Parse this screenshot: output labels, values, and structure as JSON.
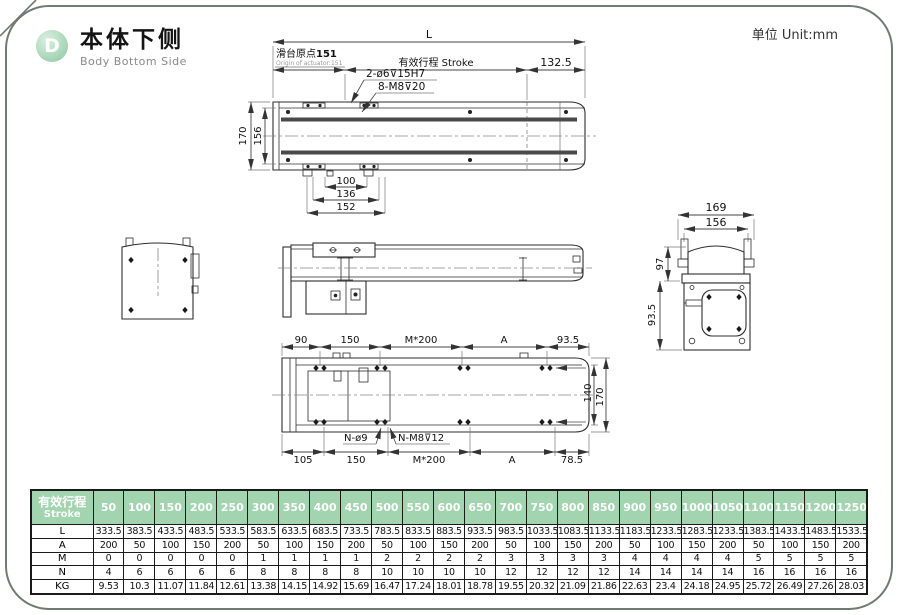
{
  "header": {
    "badge": "D",
    "title": "本体下侧",
    "subtitle": "Body Bottom Side",
    "unit_label": "单位 Unit:mm"
  },
  "colors": {
    "accent_green": "#a2d4af",
    "badge_green": "#8cc7a0",
    "line": "#444444",
    "border": "#6f7a72"
  },
  "top_view": {
    "dim_L": "L",
    "origin_label": "滑台原点",
    "origin_value": "151",
    "origin_sub": "Origin of actuator:151",
    "stroke_label": "有效行程 Stroke",
    "dim_right": "132.5",
    "dim_height_outer": "170",
    "dim_height_inner": "156",
    "hole_note_1": "2-ø6⊽15H7",
    "hole_note_2": "8-M8⊽20",
    "dim_w1": "100",
    "dim_w2": "136",
    "dim_w3": "152"
  },
  "end_view": {
    "dim_w_outer": "169",
    "dim_w_inner": "156",
    "dim_h_upper": "97",
    "dim_h_lower": "93.5"
  },
  "bottom_view": {
    "dims_top": [
      "90",
      "150",
      "M*200",
      "A",
      "93.5"
    ],
    "dims_bottom": [
      "105",
      "150",
      "M*200",
      "A",
      "78.5"
    ],
    "note_1": "N-ø9",
    "note_2": "N-M8⊽12",
    "dim_h_inner": "140",
    "dim_h_outer": "170"
  },
  "table": {
    "header_label_cn": "有效行程",
    "header_label_en": "Stroke",
    "stroke_values": [
      "50",
      "100",
      "150",
      "200",
      "250",
      "300",
      "350",
      "400",
      "450",
      "500",
      "550",
      "600",
      "650",
      "700",
      "750",
      "800",
      "850",
      "900",
      "950",
      "1000",
      "1050",
      "1100",
      "1150",
      "1200",
      "1250"
    ],
    "rows": [
      {
        "label": "L",
        "values": [
          "333.5",
          "383.5",
          "433.5",
          "483.5",
          "533.5",
          "583.5",
          "633.5",
          "683.5",
          "733.5",
          "783.5",
          "833.5",
          "883.5",
          "933.5",
          "983.5",
          "1033.5",
          "1083.5",
          "1133.5",
          "1183.5",
          "1233.5",
          "1283.5",
          "1233.5",
          "1383.5",
          "1433.5",
          "1483.5",
          "1533.5"
        ]
      },
      {
        "label": "A",
        "values": [
          "200",
          "50",
          "100",
          "150",
          "200",
          "50",
          "100",
          "150",
          "200",
          "50",
          "100",
          "150",
          "200",
          "50",
          "100",
          "150",
          "200",
          "50",
          "100",
          "150",
          "200",
          "50",
          "100",
          "150",
          "200"
        ]
      },
      {
        "label": "M",
        "values": [
          "0",
          "0",
          "0",
          "0",
          "0",
          "1",
          "1",
          "1",
          "1",
          "2",
          "2",
          "2",
          "2",
          "3",
          "3",
          "3",
          "3",
          "4",
          "4",
          "4",
          "4",
          "5",
          "5",
          "5",
          "5"
        ]
      },
      {
        "label": "N",
        "values": [
          "4",
          "6",
          "6",
          "6",
          "6",
          "8",
          "8",
          "8",
          "8",
          "10",
          "10",
          "10",
          "10",
          "12",
          "12",
          "12",
          "12",
          "14",
          "14",
          "14",
          "14",
          "16",
          "16",
          "16",
          "16"
        ]
      },
      {
        "label": "KG",
        "values": [
          "9.53",
          "10.3",
          "11.07",
          "11.84",
          "12.61",
          "13.38",
          "14.15",
          "14.92",
          "15.69",
          "16.47",
          "17.24",
          "18.01",
          "18.78",
          "19.55",
          "20.32",
          "21.09",
          "21.86",
          "22.63",
          "23.4",
          "24.18",
          "24.95",
          "25.72",
          "26.49",
          "27.26",
          "28.03"
        ]
      }
    ]
  }
}
